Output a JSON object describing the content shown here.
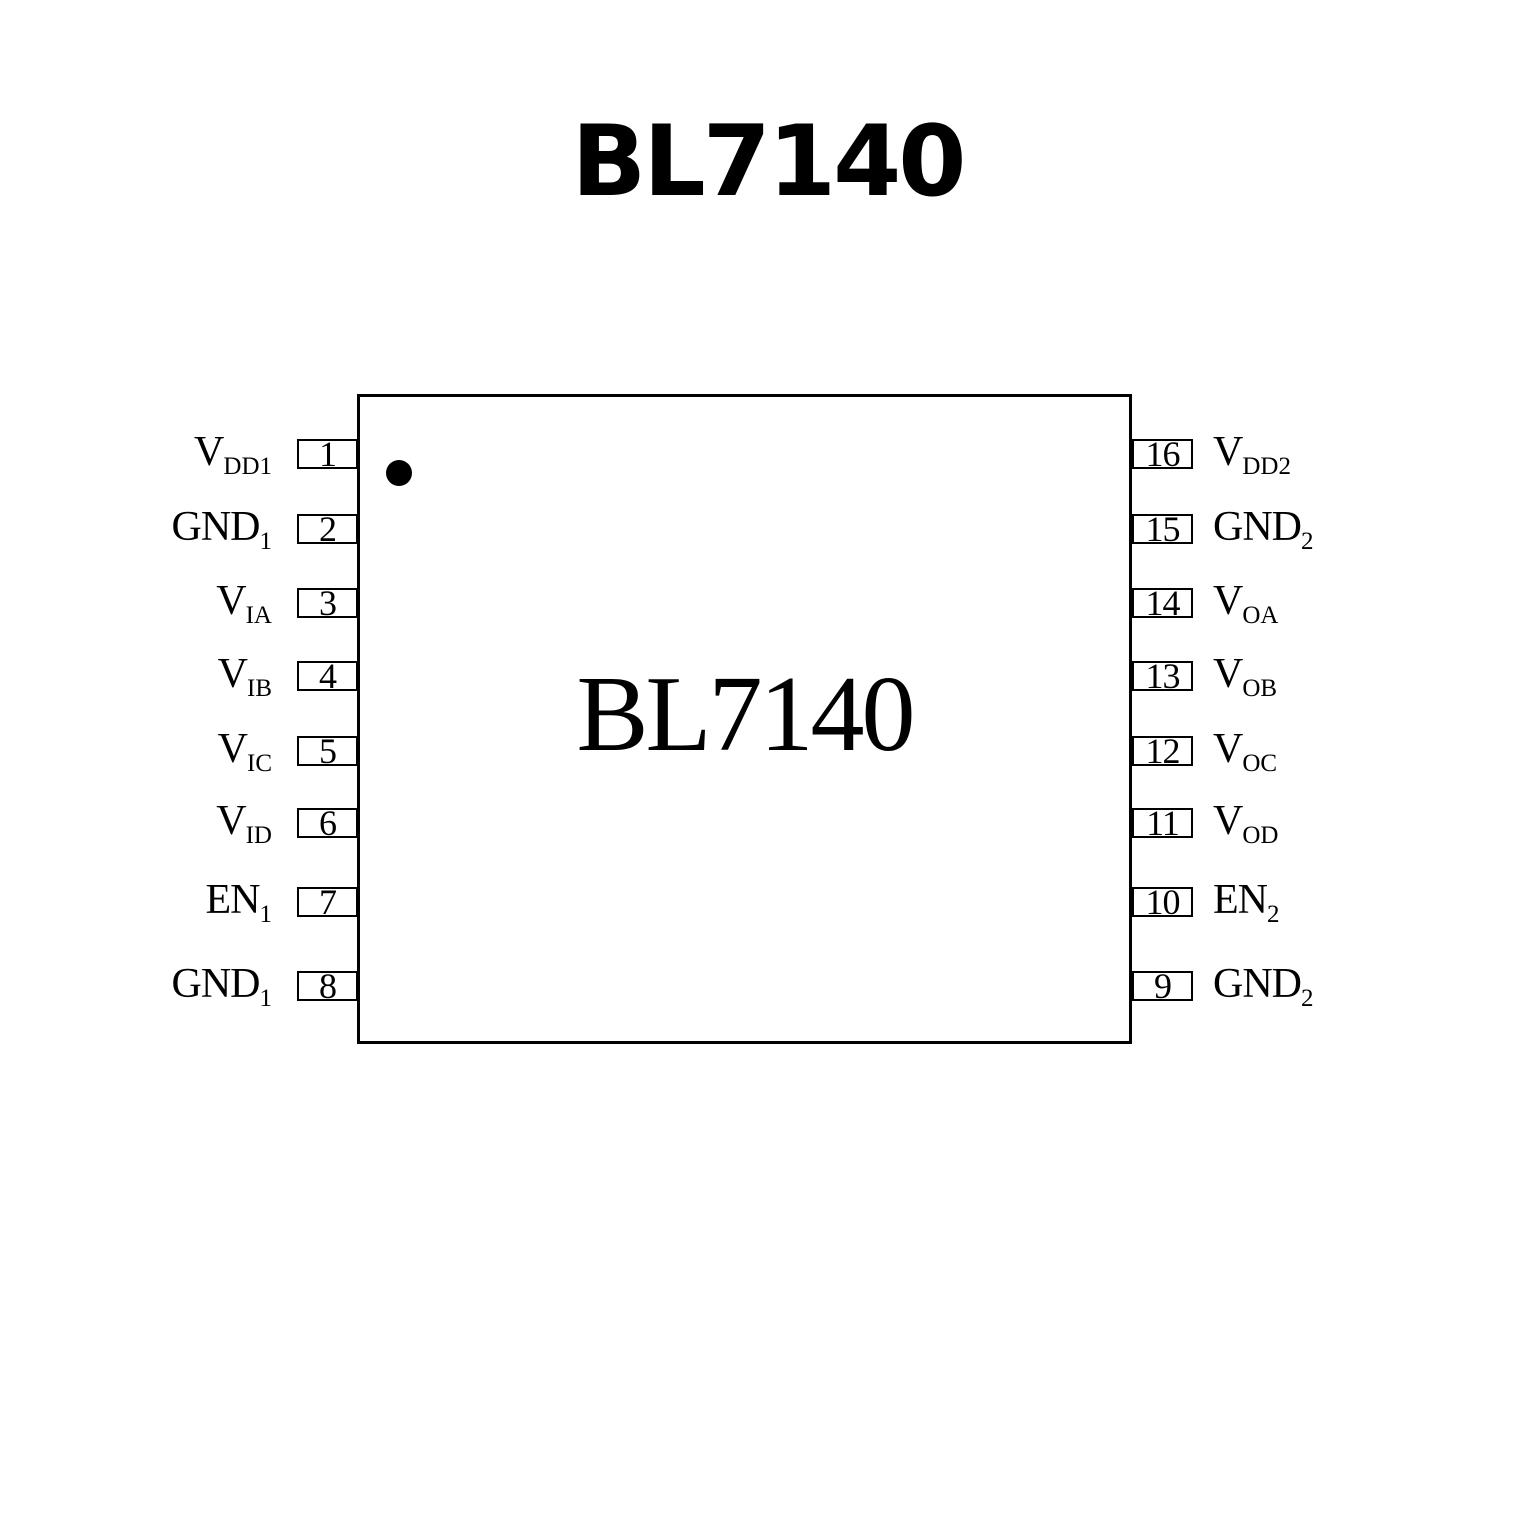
{
  "title": "BL7140",
  "chip": {
    "label": "BL7140",
    "left_pins": [
      {
        "number": "1",
        "name": "V",
        "sub": "DD1"
      },
      {
        "number": "2",
        "name": "GND",
        "sub": "1"
      },
      {
        "number": "3",
        "name": "V",
        "sub": "IA"
      },
      {
        "number": "4",
        "name": "V",
        "sub": "IB"
      },
      {
        "number": "5",
        "name": "V",
        "sub": "IC"
      },
      {
        "number": "6",
        "name": "V",
        "sub": "ID"
      },
      {
        "number": "7",
        "name": "EN",
        "sub": "1"
      },
      {
        "number": "8",
        "name": "GND",
        "sub": "1"
      }
    ],
    "right_pins": [
      {
        "number": "16",
        "name": "V",
        "sub": "DD2"
      },
      {
        "number": "15",
        "name": "GND",
        "sub": "2"
      },
      {
        "number": "14",
        "name": "V",
        "sub": "OA"
      },
      {
        "number": "13",
        "name": "V",
        "sub": "OB"
      },
      {
        "number": "12",
        "name": "V",
        "sub": "OC"
      },
      {
        "number": "11",
        "name": "V",
        "sub": "OD"
      },
      {
        "number": "10",
        "name": "EN",
        "sub": "2"
      },
      {
        "number": "9",
        "name": "GND",
        "sub": "2"
      }
    ]
  }
}
